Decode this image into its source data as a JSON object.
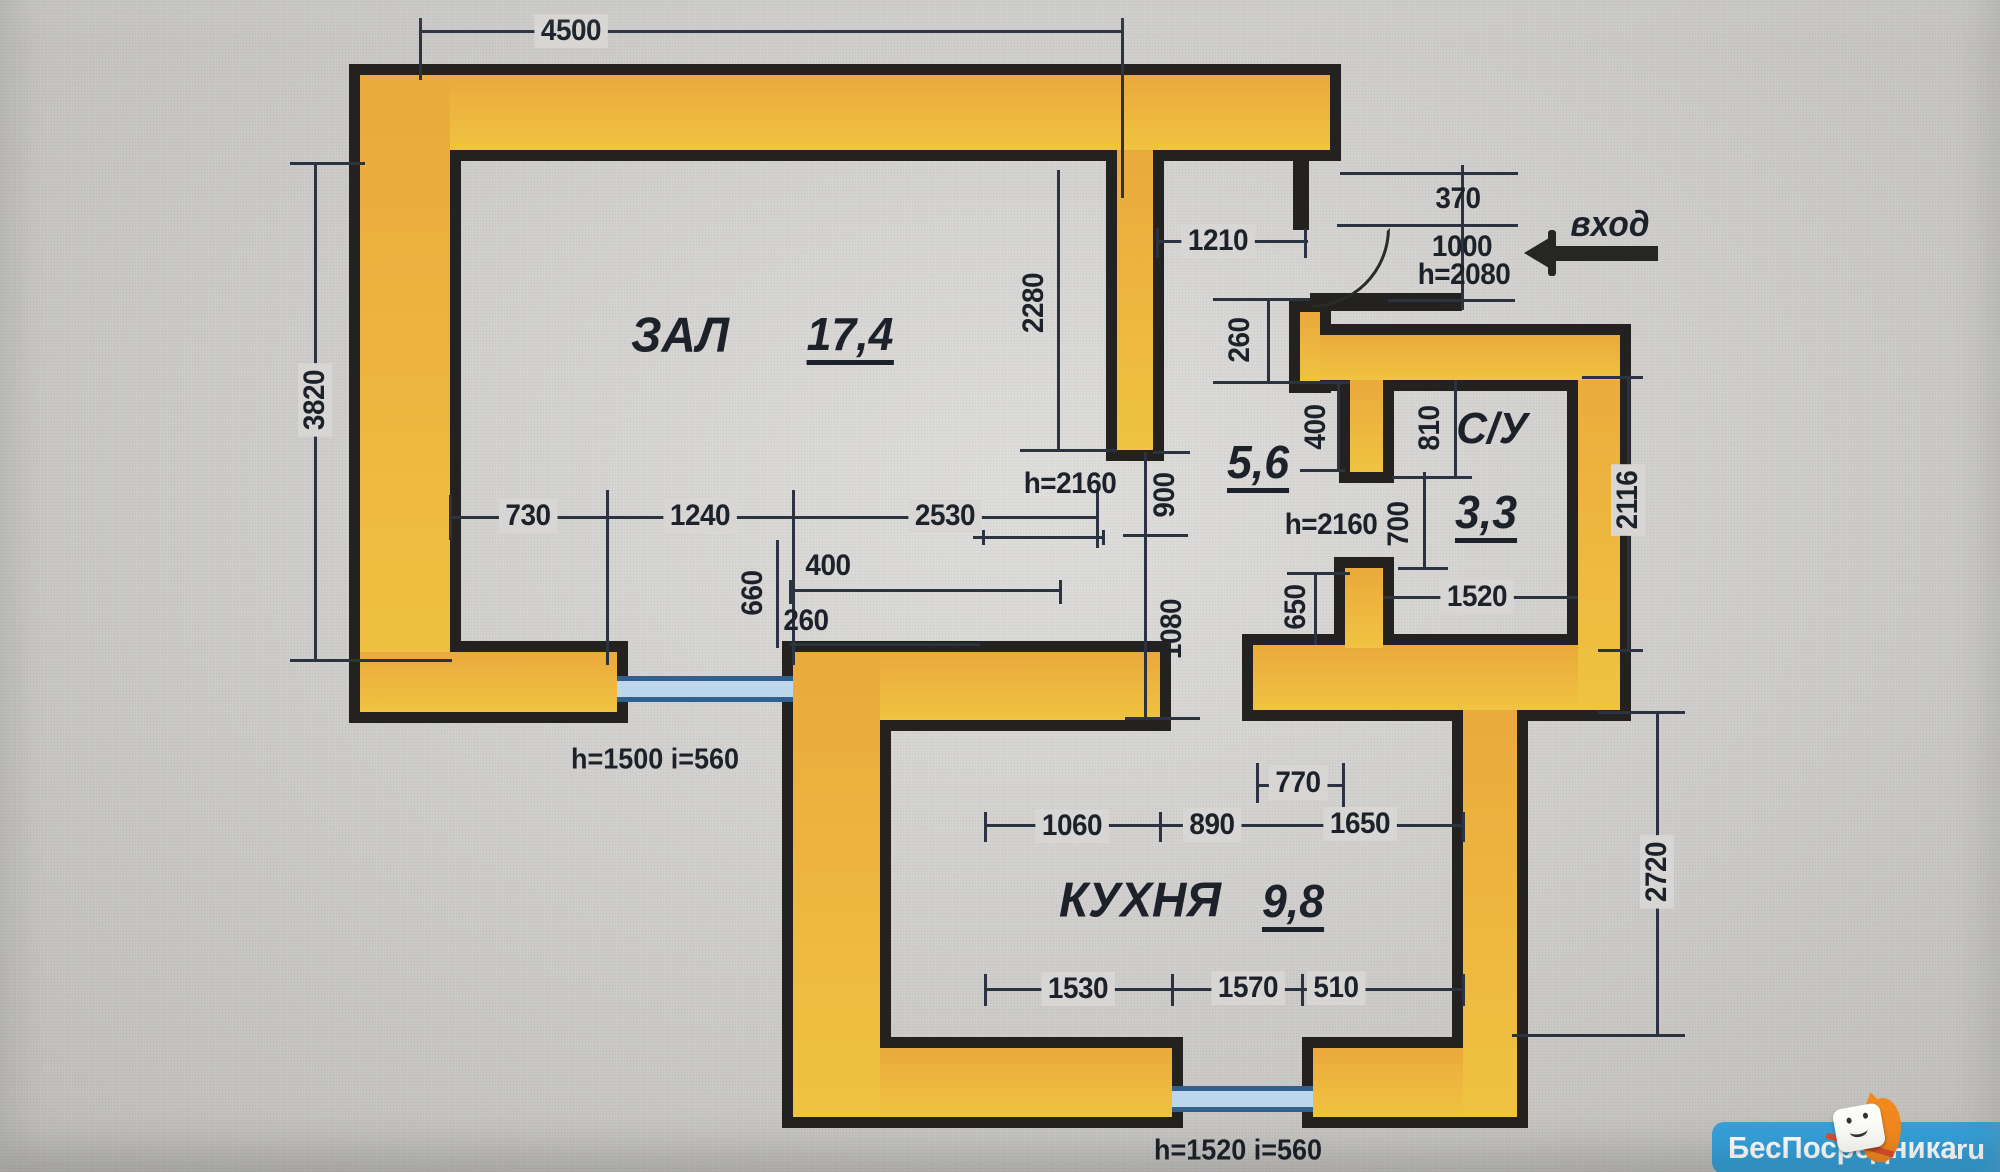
{
  "rooms": {
    "zal": {
      "label": "ЗАЛ",
      "area": "17,4"
    },
    "kitchen": {
      "label": "КУХНЯ",
      "area": "9,8"
    },
    "bathroom": {
      "label": "С/У",
      "area": "3,3"
    },
    "hallway": {
      "area": "5,6"
    }
  },
  "entry": {
    "label": "вход"
  },
  "dims": {
    "top_width": "4500",
    "left_height": "3820",
    "zal_opening": "1210",
    "entry_offset": "370",
    "entry_width": "1000",
    "entry_door_height": "h=2080",
    "zal_inner_height": "2280",
    "hall_offset_260": "260",
    "hall_offset_400": "400",
    "su_810": "810",
    "su_700": "700",
    "su_door_height": "h=2160",
    "zal_door_height": "h=2160",
    "zal_door_width": "900",
    "hall_kitchen_opening": "1080",
    "su_width": "1520",
    "su_side": "2116",
    "hall_650": "650",
    "zal_b730": "730",
    "zal_b1240": "1240",
    "zal_b2530": "2530",
    "niche_400": "400",
    "niche_260": "260",
    "niche_660": "660",
    "kitchen_770": "770",
    "kitchen_1060": "1060",
    "kitchen_890": "890",
    "kitchen_1650": "1650",
    "kitchen_side": "2720",
    "kitchen_b1530": "1530",
    "kitchen_b1570": "1570",
    "kitchen_b510": "510",
    "window_zal": "h=1500 i=560",
    "window_kitchen": "h=1520 i=560"
  },
  "watermark": {
    "site": "БесПосредника",
    "tld": ".ru"
  },
  "colors": {
    "wall_fill": "#edb23f",
    "wall_outline": "#232220",
    "dimension": "#2b3340",
    "window_line": "#31608f",
    "window_fill": "#bdd8ec",
    "watermark_bg": "#36a2da"
  }
}
